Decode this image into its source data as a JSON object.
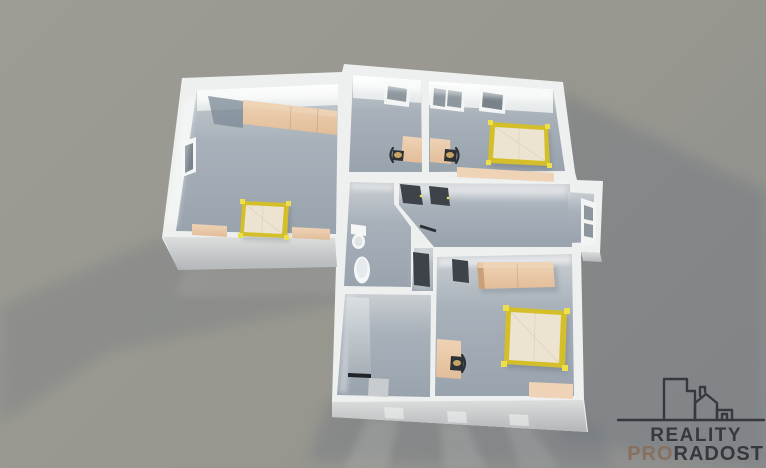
{
  "branding": {
    "logo_line1": "REALITY",
    "logo_line2_accent": "PRO",
    "logo_line2_rest": "RADOST",
    "logo_icon": "buildings-outline-icon"
  },
  "palette": {
    "bg": "#98978f",
    "bg-light": "#9d9c94",
    "bg-dark": "#8d8f8e",
    "cast-shadow": "#6f7680",
    "wall-top": "#eef0f0",
    "wall-bright": "#f7f8f8",
    "south-light": "#dcdedd",
    "south-dark": "#b2b6b8",
    "floor-light": "#c9ced2",
    "floor-mid": "#a8b1ba",
    "floor-dark": "#99a3ad",
    "frame": "#f3f5f5",
    "glass": "#8e979e",
    "glass-dark": "#78828a",
    "tan": "#e2bd99",
    "tan-dark": "#c9a079",
    "tan-light": "#efd3b6",
    "bed-yellow": "#d4bf2b",
    "bed-knob": "#eee04a",
    "mattress": "#ece4d0",
    "door-dark": "#3e434a",
    "chair-dark": "#2d3136",
    "ceramic": "#f5f7f7",
    "logo-dark": "#35393d",
    "logo-accent": "#87705f"
  },
  "scene": {
    "type": "3d-floor-plan-render",
    "rooms": [
      "bedroom-left",
      "room-top-center",
      "bedroom-top-right",
      "hallway",
      "wc",
      "bathroom-passage",
      "bathroom",
      "bedroom-bottom"
    ],
    "furniture": [
      "wardrobe",
      "single-bed",
      "nightstand",
      "desk",
      "chair",
      "double-bed",
      "sideboard",
      "toilet",
      "pedestal-sink",
      "shower-glass-panel",
      "bath-mat",
      "dresser"
    ],
    "features": [
      "windows",
      "open-dark-doors",
      "glazed-entry-door",
      "cast-shadows",
      "window-light-streaks"
    ]
  }
}
